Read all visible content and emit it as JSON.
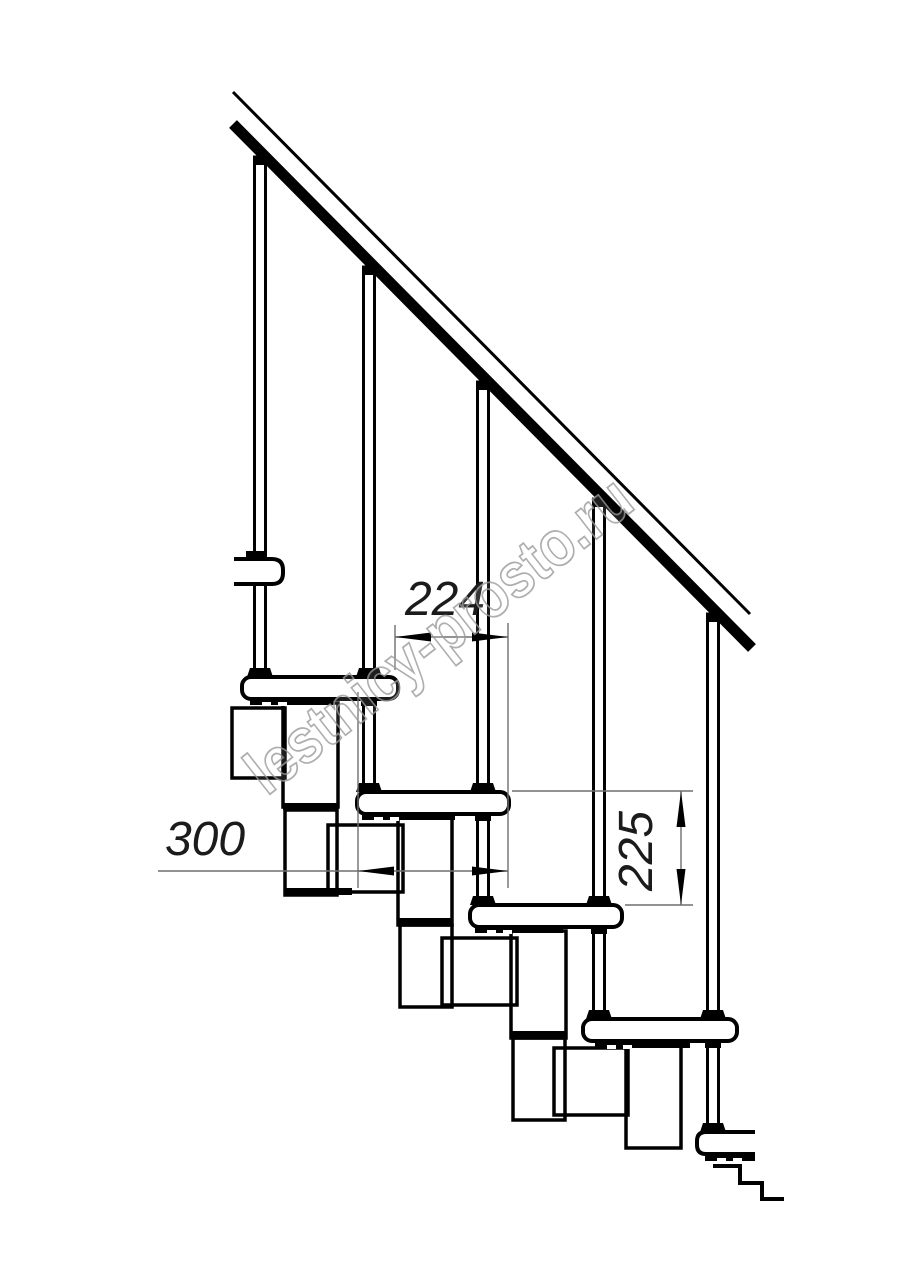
{
  "canvas": {
    "width": 914,
    "height": 1280,
    "background": "#ffffff",
    "line_color": "#000000",
    "thin_line_color": "#6f6f6f",
    "label_color": "#1b1b1b",
    "label_font_size": 48
  },
  "watermark": {
    "text": "lestnicy-prosto.ru",
    "center_x": 452,
    "center_y": 652,
    "angle_deg": -38,
    "font_size": 64,
    "text_length": 470,
    "stroke_color": "#9b9b9b",
    "stroke_width": 1.8,
    "fill_color": "#ffffff",
    "fill_opacity": 0.15,
    "opacity": 0.8
  },
  "drawing": {
    "rail": {
      "thin_line": [
        233,
        92,
        750,
        614
      ],
      "thin_width": 3,
      "band": [
        233,
        124,
        752,
        648
      ],
      "band_width": 11
    },
    "rail_bracket": {
      "x": 234,
      "y": 559,
      "w": 49,
      "h": 25,
      "r": 11,
      "collar": [
        246,
        551,
        19,
        9
      ]
    },
    "balusters": [
      {
        "x": 260,
        "top": 157,
        "bottom": 677
      },
      {
        "x": 369,
        "top": 267,
        "bottom": 677
      },
      {
        "x": 483,
        "top": 382,
        "bottom": 792
      },
      {
        "x": 599,
        "top": 499,
        "bottom": 905
      },
      {
        "x": 713,
        "top": 614,
        "bottom": 1019
      }
    ],
    "bolts": [
      {
        "x": 369,
        "top": 699,
        "bottom": 792
      },
      {
        "x": 483,
        "top": 814,
        "bottom": 905
      },
      {
        "x": 599,
        "top": 927,
        "bottom": 1019
      },
      {
        "x": 713,
        "top": 1041,
        "bottom": 1132
      }
    ],
    "treads": [
      {
        "x": 242,
        "y": 677,
        "w": 156,
        "h": 22
      },
      {
        "x": 357,
        "y": 792,
        "w": 152,
        "h": 22
      },
      {
        "x": 470,
        "y": 905,
        "w": 152,
        "h": 22
      },
      {
        "x": 583,
        "y": 1019,
        "w": 154,
        "h": 22
      },
      {
        "x": 697,
        "y": 1132,
        "w": 58,
        "h": 22,
        "cut_right": true
      }
    ],
    "plates": [
      [
        250,
        698,
        83,
        7
      ],
      [
        362,
        813,
        93,
        7
      ],
      [
        475,
        926,
        88,
        7
      ],
      [
        595,
        1041,
        95,
        7
      ],
      [
        705,
        1154,
        50,
        7
      ]
    ],
    "modules": [
      {
        "side": [
          232,
          708,
          53,
          70
        ],
        "tall1": [
          283,
          703,
          55,
          104
        ],
        "joint": [
          283,
          803,
          55,
          7
        ],
        "tall2": [
          285,
          810,
          52,
          85
        ],
        "bottom": [
          285,
          888,
          67,
          7
        ]
      },
      {
        "side": [
          328,
          825,
          75,
          67
        ],
        "tall1": [
          398,
          818,
          54,
          107
        ],
        "joint": [
          398,
          918,
          54,
          7
        ],
        "tall2": [
          400,
          925,
          52,
          82
        ],
        "bottom": null
      },
      {
        "side": [
          442,
          938,
          75,
          67
        ],
        "tall1": [
          511,
          931,
          55,
          107
        ],
        "joint": [
          511,
          1031,
          55,
          7
        ],
        "tall2": [
          513,
          1038,
          52,
          82
        ],
        "bottom": null
      },
      {
        "side": [
          554,
          1048,
          74,
          67
        ],
        "tall1": [
          626,
          1046,
          55,
          102
        ],
        "joint": null,
        "tall2": null,
        "bottom": null
      }
    ],
    "floor_outline": [
      [
        713,
        1166
      ],
      [
        740,
        1166
      ],
      [
        740,
        1183
      ],
      [
        762,
        1183
      ],
      [
        762,
        1199
      ],
      [
        784,
        1199
      ]
    ]
  },
  "dimensions": {
    "run": {
      "label": "224",
      "line": [
        395,
        637,
        508,
        637
      ],
      "arrows": [
        {
          "tip": [
            395,
            637
          ],
          "dir": "left"
        },
        {
          "tip": [
            508,
            637
          ],
          "dir": "right"
        }
      ],
      "extensions": [
        [
          395,
          625,
          395,
          670
        ],
        [
          508,
          623,
          508,
          888
        ]
      ],
      "label_x": 445,
      "label_y": 615,
      "rotate": 0
    },
    "tread_depth": {
      "label": "300",
      "line": [
        158,
        871,
        508,
        871
      ],
      "arrows": [
        {
          "tip": [
            358,
            871
          ],
          "dir": "left"
        },
        {
          "tip": [
            508,
            871
          ],
          "dir": "right"
        }
      ],
      "extensions": [
        [
          358,
          692,
          358,
          888
        ]
      ],
      "label_x": 205,
      "label_y": 855,
      "rotate": 0
    },
    "rise": {
      "label": "225",
      "line": [
        681,
        791,
        681,
        905
      ],
      "arrows": [
        {
          "tip": [
            681,
            791
          ],
          "dir": "up"
        },
        {
          "tip": [
            681,
            905
          ],
          "dir": "down"
        }
      ],
      "extensions": [
        [
          512,
          791,
          693,
          791
        ],
        [
          625,
          905,
          693,
          905
        ]
      ],
      "label_x": 652,
      "label_y": 851,
      "rotate": -90
    }
  }
}
